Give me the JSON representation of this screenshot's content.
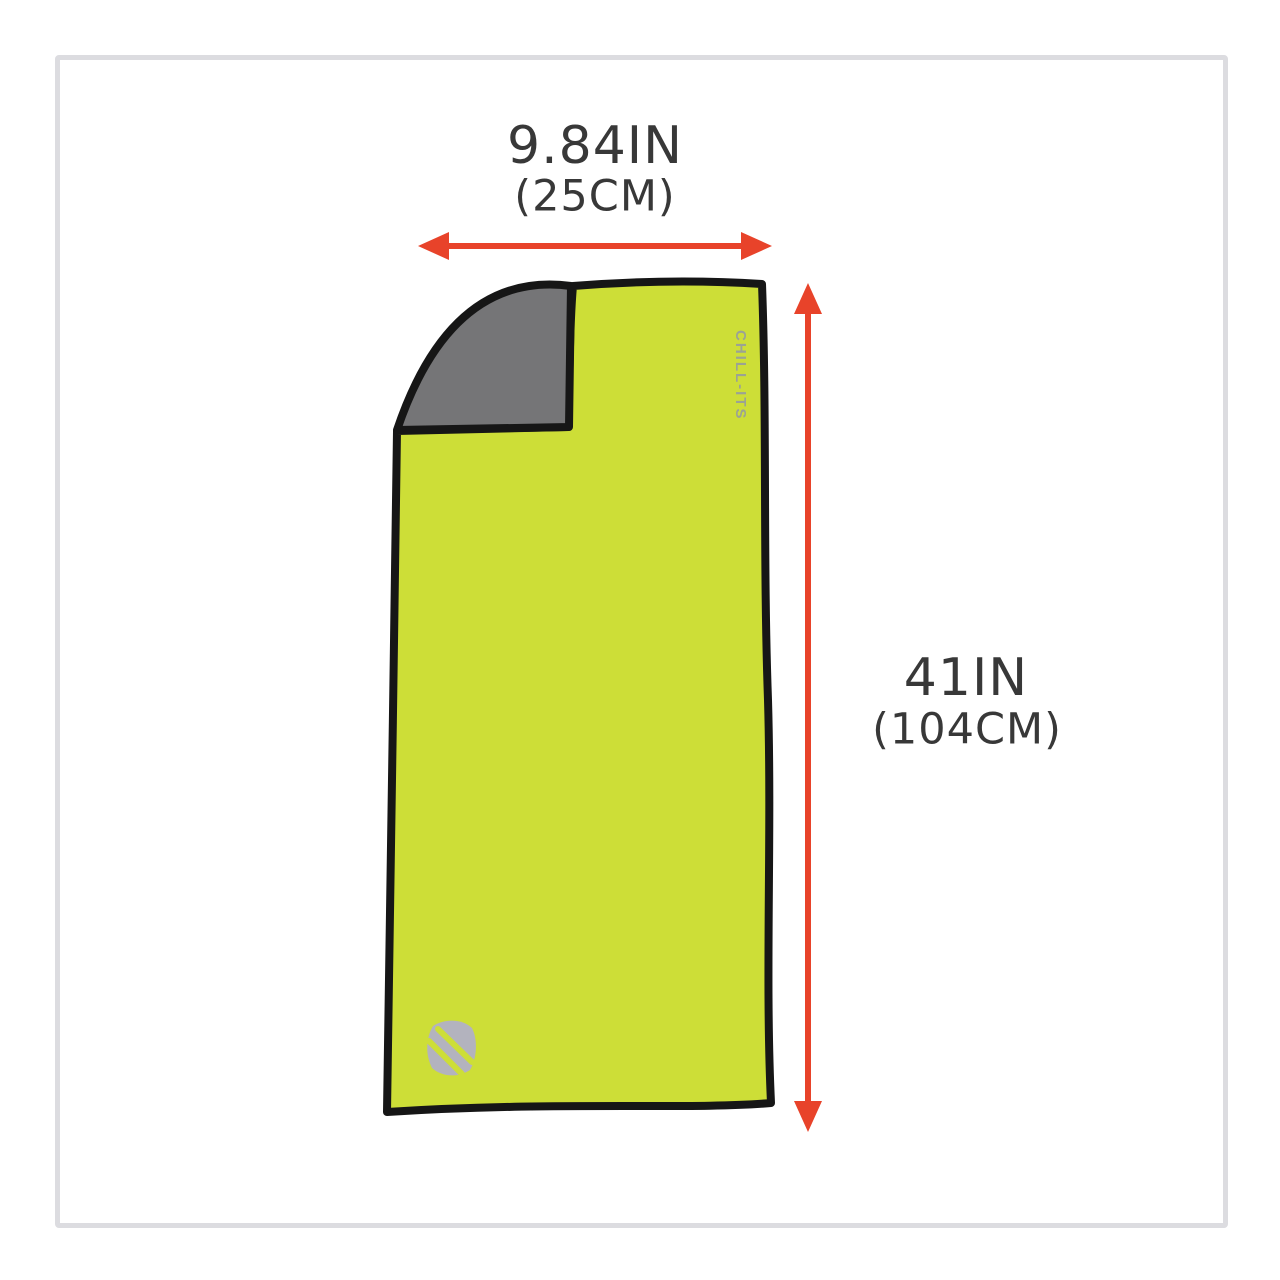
{
  "colors": {
    "towel-front": "#cdde37",
    "towel-back": "#757577",
    "outline": "#161616",
    "arrow": "#e8432a",
    "label-text": "#383838",
    "frame-border": "#dcdce0",
    "brand-mark": "#b3b3be",
    "brand-text": "#9ba394"
  },
  "dimensions": {
    "width": {
      "inches": "9.84IN",
      "metric": "(25CM)"
    },
    "height": {
      "inches": "41IN",
      "metric": "(104CM)"
    }
  },
  "towel": {
    "brand_text": "CHILL-ITS"
  }
}
